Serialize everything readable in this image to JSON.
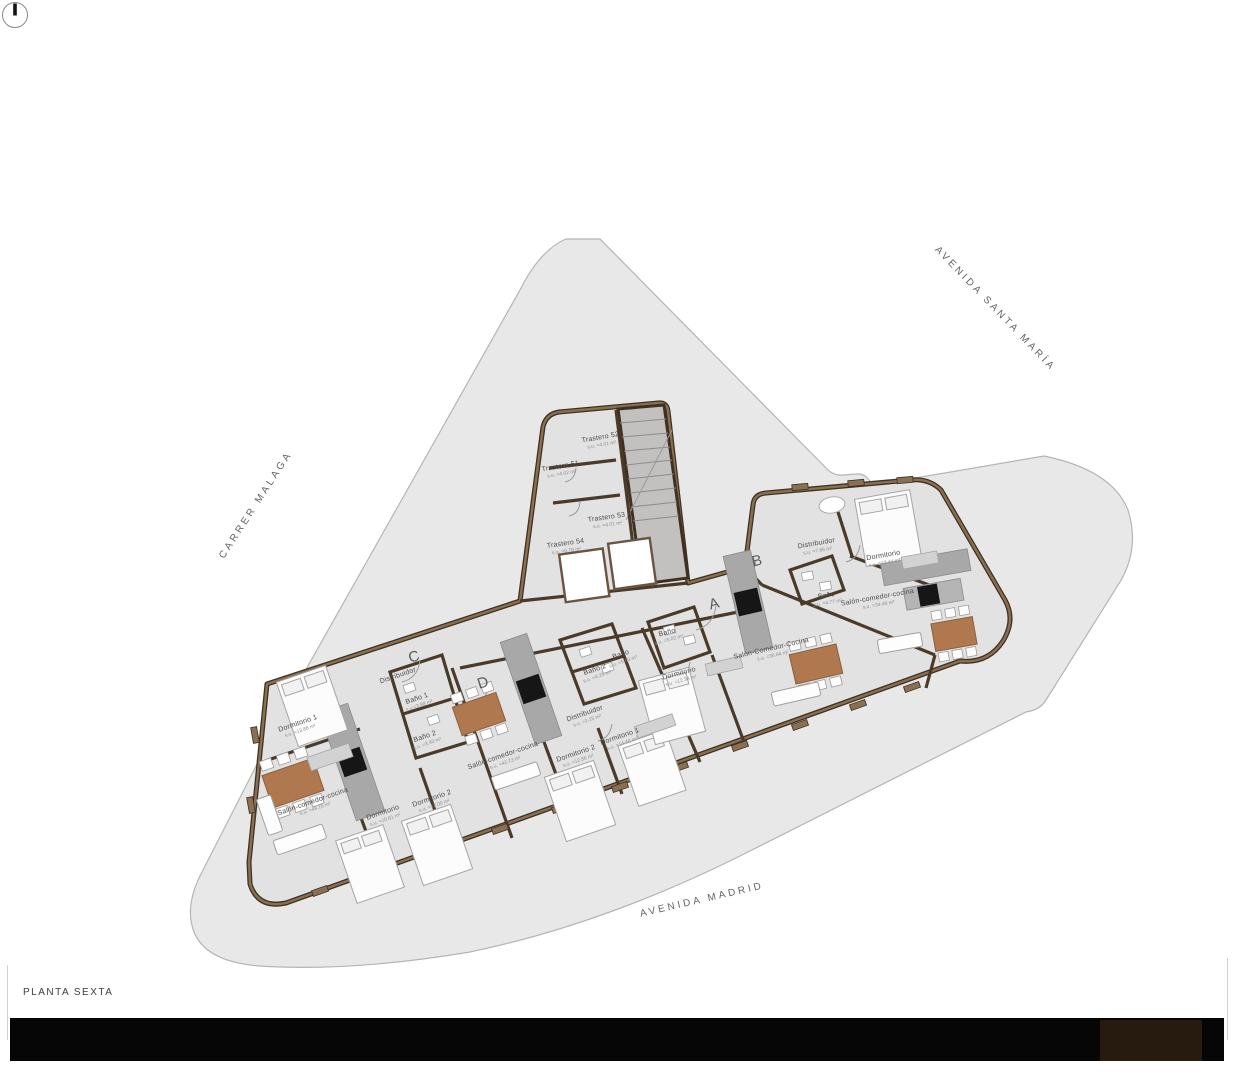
{
  "sheet": {
    "title": "PLANTA SEXTA"
  },
  "streets": [
    {
      "id": "carrer-malaga",
      "label": "CARRER MALAGA",
      "x": 256,
      "y": 505,
      "rot": -57
    },
    {
      "id": "avenida-santa-maria",
      "label": "AVENIDA SANTA MARÍA",
      "x": 995,
      "y": 309,
      "rot": 46
    },
    {
      "id": "avenida-madrid",
      "label": "AVENIDA MADRID",
      "x": 702,
      "y": 900,
      "rot": -13
    }
  ],
  "units": [
    {
      "letter": "A",
      "x": 714,
      "y": 604,
      "rot": -15
    },
    {
      "letter": "B",
      "x": 757,
      "y": 561,
      "rot": -12
    },
    {
      "letter": "C",
      "x": 414,
      "y": 657,
      "rot": -17
    },
    {
      "letter": "D",
      "x": 483,
      "y": 683,
      "rot": -17
    }
  ],
  "rooms": [
    {
      "label": "Trastero 52",
      "area": "s.u. =4.01 m²",
      "x": 601,
      "y": 441,
      "rot": -10
    },
    {
      "label": "Trastero 51",
      "area": "s.u. =4.02 m²",
      "x": 561,
      "y": 470,
      "rot": -10
    },
    {
      "label": "Trastero 53",
      "area": "s.u. =4.01 m²",
      "x": 607,
      "y": 521,
      "rot": -8
    },
    {
      "label": "Trastero 54",
      "area": "s.u. =6.78 m²",
      "x": 566,
      "y": 547,
      "rot": -8
    },
    {
      "label": "Distribuidor",
      "area": "s.u. =7.86 m²",
      "x": 817,
      "y": 547,
      "rot": -10
    },
    {
      "label": "Dormitorio",
      "area": "s.u. =12.44 m²",
      "x": 884,
      "y": 559,
      "rot": -10
    },
    {
      "label": "Baño",
      "area": "s.u. =4.77 m²",
      "x": 827,
      "y": 599,
      "rot": -10
    },
    {
      "label": "Salón-comedor-cocina",
      "area": "s.u. =34.49 m²",
      "x": 878,
      "y": 601,
      "rot": -10
    },
    {
      "label": "Salón-Comedor-Cocina",
      "area": "s.u. =36.84 m²",
      "x": 772,
      "y": 652,
      "rot": -13
    },
    {
      "label": "Baño",
      "area": "s.u. =5.02 m²",
      "x": 668,
      "y": 636,
      "rot": -15
    },
    {
      "label": "Dormitorio",
      "area": "s.u. =12.38 m²",
      "x": 680,
      "y": 677,
      "rot": -15
    },
    {
      "label": "Baño",
      "area": "s.u. =5.03 m²",
      "x": 622,
      "y": 658,
      "rot": -19
    },
    {
      "label": "Baño 2",
      "area": "s.u. =4.25 m²",
      "x": 596,
      "y": 673,
      "rot": -19
    },
    {
      "label": "Distribuidor",
      "area": "s.u. =2.25 m²",
      "x": 586,
      "y": 717,
      "rot": -19
    },
    {
      "label": "Dormitorio 1",
      "area": "s.u. =14.40 m²",
      "x": 621,
      "y": 740,
      "rot": -19
    },
    {
      "label": "Dormitorio 2",
      "area": "s.u. =12.56 m²",
      "x": 577,
      "y": 757,
      "rot": -19
    },
    {
      "label": "Salón-comedor-cocina",
      "area": "s.u. =42.73 m²",
      "x": 504,
      "y": 759,
      "rot": -19
    },
    {
      "label": "Distribuidor",
      "area": "",
      "x": 398,
      "y": 676,
      "rot": -19
    },
    {
      "label": "Baño 1",
      "area": "s.u.=3.88 m²",
      "x": 418,
      "y": 702,
      "rot": -19
    },
    {
      "label": "Baño 2",
      "area": "s.u. =3.93 m²",
      "x": 426,
      "y": 740,
      "rot": -19
    },
    {
      "label": "Dormitorio 1",
      "area": "s.u. =13.88 m²",
      "x": 299,
      "y": 727,
      "rot": -19
    },
    {
      "label": "Salón-comedor-cocina",
      "area": "s.u. =48.15 m²",
      "x": 314,
      "y": 805,
      "rot": -19
    },
    {
      "label": "Dormitorio",
      "area": "s.u. =10.61 m²",
      "x": 384,
      "y": 816,
      "rot": -19
    },
    {
      "label": "Dormitorio 2",
      "area": "s.u. =12.00 m²",
      "x": 433,
      "y": 802,
      "rot": -19
    }
  ],
  "colors": {
    "wall_brown_dark": "#3f3122",
    "wall_brown_light": "#8a7053",
    "parcel_gray": "#e8e8e8",
    "building_gray": "#e2e2e2",
    "table_brown": "#b0784e",
    "appliance_black": "#161616",
    "bar_black": "#060606",
    "bar_brown": "#271b10"
  }
}
